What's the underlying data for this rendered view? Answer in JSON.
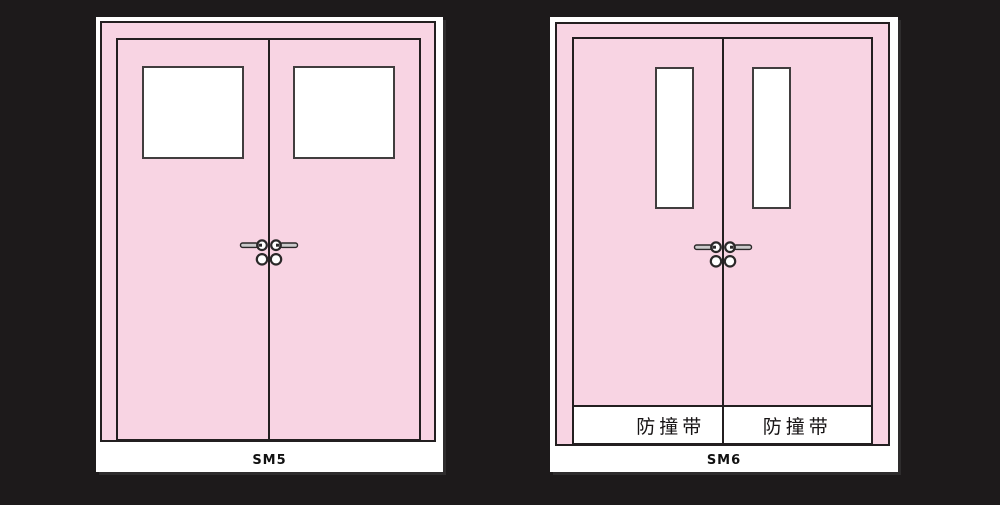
{
  "colors": {
    "background": "#1d1a1b",
    "card": "#ffffff",
    "door_pink": "#f8d4e3",
    "outline": "#231f20",
    "panel_outline": "#413d3e",
    "hardware_stroke": "#2b2829",
    "hardware_bar_fill": "#cbcacb",
    "hardware_face_fill": "#ffffff",
    "band_background": "#ffffff",
    "label_color": "#111111"
  },
  "figures": {
    "sm5": {
      "label": "SM5"
    },
    "sm6": {
      "label": "SM6",
      "bands": {
        "left": "防撞带",
        "right": "防撞带"
      }
    }
  },
  "icons": {
    "lever_handle": "lever-handle-icon",
    "lock_cylinder": "lock-cylinder-icon"
  }
}
